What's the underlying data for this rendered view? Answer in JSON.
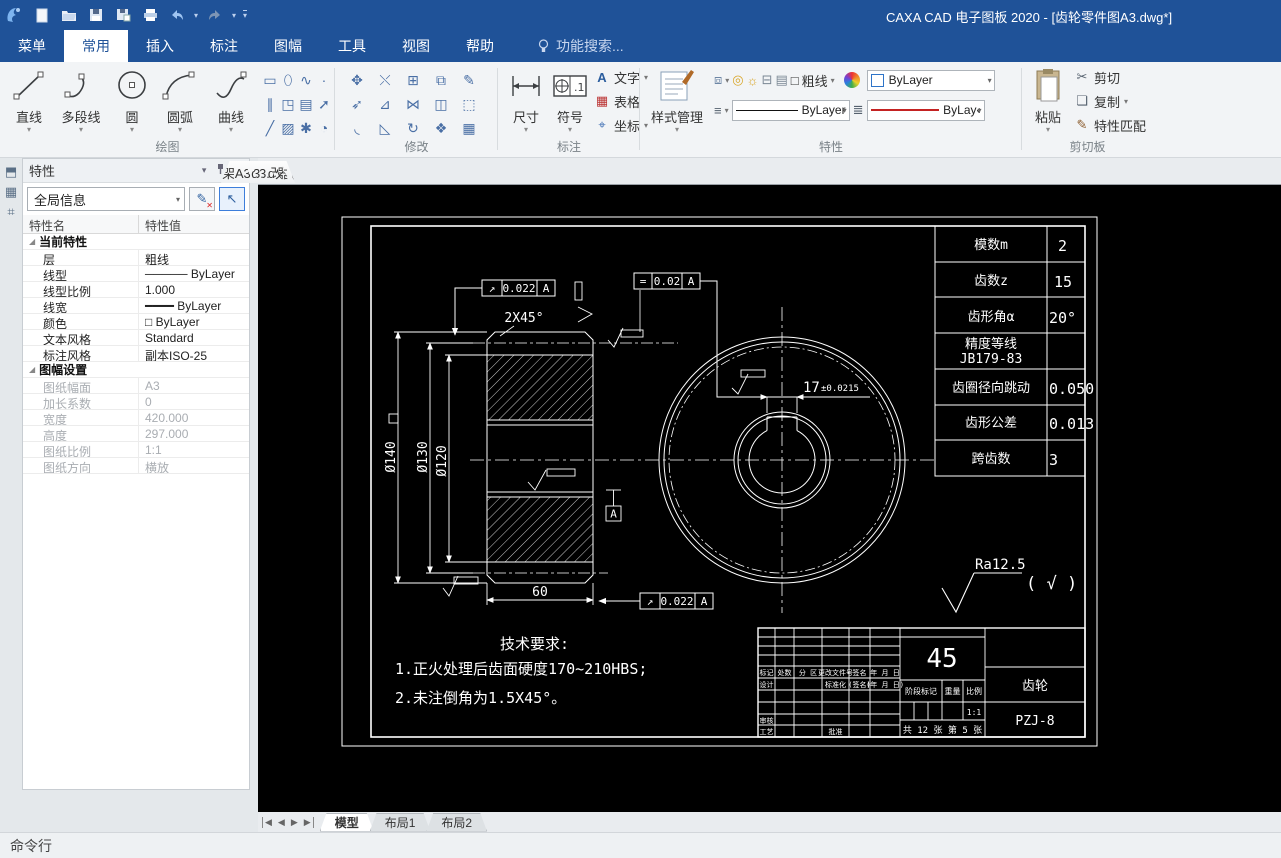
{
  "window": {
    "title": "CAXA CAD 电子图板 2020 - [齿轮零件图A3.dwg*]"
  },
  "menu": {
    "tabs": [
      {
        "label": "菜单",
        "cls": ""
      },
      {
        "label": "常用",
        "cls": "active"
      },
      {
        "label": "插入",
        "cls": ""
      },
      {
        "label": "标注",
        "cls": ""
      },
      {
        "label": "图幅",
        "cls": ""
      },
      {
        "label": "工具",
        "cls": ""
      },
      {
        "label": "视图",
        "cls": ""
      },
      {
        "label": "帮助",
        "cls": ""
      }
    ],
    "search_label": "功能搜索..."
  },
  "ribbon": {
    "draw": {
      "label": "绘图",
      "big": [
        {
          "label": "直线"
        },
        {
          "label": "多段线"
        },
        {
          "label": "圆"
        },
        {
          "label": "圆弧"
        },
        {
          "label": "曲线"
        }
      ],
      "grid_icons": [
        {
          "name": "rectangle-icon",
          "glyph": "▭"
        },
        {
          "name": "ellipse-icon",
          "glyph": "⬯"
        },
        {
          "name": "formula-curve-icon",
          "glyph": "∿"
        },
        {
          "name": "point-icon",
          "glyph": "·"
        },
        {
          "name": "parallel-line-icon",
          "glyph": "∥"
        },
        {
          "name": "hole-pattern-icon",
          "glyph": "◳"
        },
        {
          "name": "insert-block-icon",
          "glyph": "▤"
        },
        {
          "name": "arrow-icon",
          "glyph": "➚"
        },
        {
          "name": "construction-line-icon",
          "glyph": "╱"
        },
        {
          "name": "hatch-icon",
          "glyph": "▨"
        },
        {
          "name": "gear-draw-icon",
          "glyph": "✱"
        },
        {
          "name": "pie-icon",
          "glyph": "◔"
        }
      ]
    },
    "modify": {
      "label": "修改",
      "grid_icons": [
        {
          "name": "move-icon",
          "glyph": "✥"
        },
        {
          "name": "break-icon",
          "glyph": "⤬"
        },
        {
          "name": "array-icon",
          "glyph": "⊞"
        },
        {
          "name": "stretch-icon",
          "glyph": "⧉"
        },
        {
          "name": "edit-icon",
          "glyph": "✎"
        },
        {
          "name": "rotate-copy-icon",
          "glyph": "➶"
        },
        {
          "name": "extend-icon",
          "glyph": "⊿"
        },
        {
          "name": "mirror-icon",
          "glyph": "⋈"
        },
        {
          "name": "corner-icon",
          "glyph": "◫"
        },
        {
          "name": "scale-icon",
          "glyph": "⬚"
        },
        {
          "name": "fillet-icon",
          "glyph": "◟"
        },
        {
          "name": "chamfer-icon",
          "glyph": "◺"
        },
        {
          "name": "rotate-icon",
          "glyph": "↻"
        },
        {
          "name": "explode-icon",
          "glyph": "❖"
        },
        {
          "name": "erase-icon",
          "glyph": "▦"
        }
      ]
    },
    "annotate": {
      "label": "标注",
      "big": [
        {
          "label": "尺寸"
        },
        {
          "label": "符号"
        }
      ],
      "small": [
        {
          "label": "文字",
          "icon": "A",
          "name": "text-icon"
        },
        {
          "label": "表格",
          "icon": "▦",
          "name": "table-icon"
        },
        {
          "label": "坐标",
          "icon": "⌖",
          "name": "coordinate-icon"
        }
      ]
    },
    "props": {
      "label": "特性",
      "style_manager": "样式管理",
      "layer_name": "粗线",
      "color_value": "ByLayer",
      "linetype_value": "ByLayer",
      "lineweight_value": "ByLay‹"
    },
    "clipboard": {
      "label": "剪切板",
      "paste": "粘贴",
      "items": [
        {
          "label": "剪切",
          "icon": "✂",
          "name": "cut-icon"
        },
        {
          "label": "复制",
          "icon": "❏",
          "name": "copy-icon"
        },
        {
          "label": "特性匹配",
          "icon": "✎",
          "name": "match-properties-icon"
        }
      ]
    }
  },
  "doc_tabs": [
    {
      "label": "自动排种箱体 (A3).dwg*"
    },
    {
      "label": "自动存储排种器(A1).dwg*"
    },
    {
      "label": "装配图修改.dwg*"
    },
    {
      "label": "支撑架.dwg*"
    },
    {
      "label": "圆锥体A3.dwg*"
    },
    {
      "label": "圆环桶A3.dwg*"
    },
    {
      "label": "凸轮A4.dwg*"
    },
    {
      "label": "平衡架A3.dwg"
    }
  ],
  "panel": {
    "title": "特性",
    "selector": "全局信息",
    "col_name": "特性名",
    "col_value": "特性值",
    "group1": "当前特性",
    "rows1": [
      {
        "n": "层",
        "v": "粗线",
        "cls": ""
      },
      {
        "n": "线型",
        "v": "───── ByLayer",
        "cls": ""
      },
      {
        "n": "线型比例",
        "v": "1.000",
        "cls": ""
      },
      {
        "n": "线宽",
        "v": "━━━━ ByLayer",
        "cls": ""
      },
      {
        "n": "颜色",
        "v": "□ ByLayer",
        "cls": ""
      },
      {
        "n": "文本风格",
        "v": "Standard",
        "cls": ""
      },
      {
        "n": "标注风格",
        "v": "副本ISO-25",
        "cls": ""
      }
    ],
    "group2": "图幅设置",
    "rows2": [
      {
        "n": "图纸幅面",
        "v": "A3",
        "cls": "muted"
      },
      {
        "n": "加长系数",
        "v": "0",
        "cls": "muted"
      },
      {
        "n": "宽度",
        "v": "420.000",
        "cls": "muted"
      },
      {
        "n": "高度",
        "v": "297.000",
        "cls": "muted"
      },
      {
        "n": "图纸比例",
        "v": "1:1",
        "cls": "muted"
      },
      {
        "n": "图纸方向",
        "v": "横放",
        "cls": "muted"
      }
    ]
  },
  "drawing": {
    "param_table": {
      "rows": [
        {
          "n": "模数m",
          "v": "2"
        },
        {
          "n": "齿数z",
          "v": "15"
        },
        {
          "n": "齿形角α",
          "v": "20°"
        },
        {
          "n1": "精度等线",
          "n2": "JB179-83",
          "v": ""
        },
        {
          "n": "齿圈径向跳动",
          "v": "0.050"
        },
        {
          "n": "齿形公差",
          "v": "0.013"
        },
        {
          "n": "跨齿数",
          "v": "3"
        }
      ]
    },
    "gdt": {
      "runout_sym": "↗",
      "runout": "0.022",
      "sym_sym": "=",
      "sym": "0.02",
      "datum": "A"
    },
    "dims": {
      "d140": "Ø140",
      "d130": "Ø130",
      "d120": "Ø120",
      "chamfer": "2X45°",
      "length": "60",
      "key": "17",
      "key_tol": "±0.0215"
    },
    "roughness": {
      "value": "Ra12.5",
      "suffix": "( √ )"
    },
    "tech": {
      "title": "技术要求:",
      "line1": "1.正火处理后齿面硬度170~210HBS;",
      "line2": "2.未注倒角为1.5X45°。"
    },
    "titleblock": {
      "material": "45",
      "part": "齿轮",
      "dwg_no": "PZJ-8",
      "marks": [
        "标记",
        "处数",
        "分 区",
        "更改文件号",
        "签名",
        "年 月 日"
      ],
      "design": "设计",
      "std": "标准化",
      "sign": "(签名)",
      "date": "(年 月 日)",
      "check": "审核",
      "process": "工艺",
      "approve": "批准",
      "stage": "阶段标记",
      "weight": "重量",
      "scale_label": "比例",
      "scale": "1:1",
      "sheet": "共 12 张 第 5 张"
    }
  },
  "layout_tabs": {
    "tabs": [
      {
        "label": "模型",
        "cls": "active"
      },
      {
        "label": "布局1",
        "cls": ""
      },
      {
        "label": "布局2",
        "cls": ""
      }
    ]
  },
  "status": {
    "command": "命令行"
  }
}
